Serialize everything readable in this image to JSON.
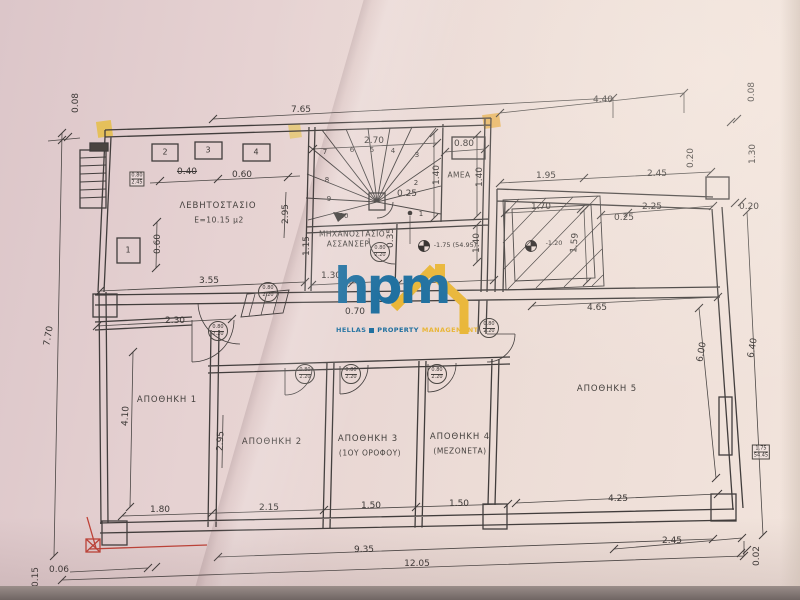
{
  "logo": {
    "wordmark": "hpm",
    "sub1": "HELLAS",
    "sub2": "PROPERTY",
    "sub3": "MANAGEMENT",
    "blue": "#1e6f9f",
    "yellow": "#e9b637"
  },
  "levels_note": "benchmark level markers shown on plan",
  "annotations": [
    {
      "text": "0.08",
      "x": 76,
      "y": 103,
      "rot": -90,
      "cls": "dim"
    },
    {
      "text": "7.65",
      "x": 301,
      "y": 110,
      "cls": "dim"
    },
    {
      "text": "4.40",
      "x": 603,
      "y": 100,
      "cls": "dim"
    },
    {
      "text": "0.08",
      "x": 752,
      "y": 92,
      "rot": -90,
      "cls": "dim"
    },
    {
      "text": "1.30",
      "x": 753,
      "y": 154,
      "rot": -90,
      "cls": "dim"
    },
    {
      "text": "0.20",
      "x": 691,
      "y": 158,
      "rot": -90,
      "cls": "dim"
    },
    {
      "text": "1.95",
      "x": 546,
      "y": 176,
      "cls": "dim"
    },
    {
      "text": "2.45",
      "x": 657,
      "y": 174,
      "cls": "dim"
    },
    {
      "text": "0.20",
      "x": 749,
      "y": 207,
      "cls": "dim"
    },
    {
      "text": "2.25",
      "x": 652,
      "y": 207,
      "cls": "dim"
    },
    {
      "text": "0.25",
      "x": 624,
      "y": 218,
      "cls": "dim"
    },
    {
      "text": "2.70",
      "x": 374,
      "y": 141,
      "cls": "dim"
    },
    {
      "text": "0.80",
      "x": 464,
      "y": 144,
      "cls": "dim"
    },
    {
      "text": "1.40",
      "x": 437,
      "y": 175,
      "rot": -90,
      "cls": "dim"
    },
    {
      "text": "1.40",
      "x": 480,
      "y": 177,
      "rot": -90,
      "cls": "dim"
    },
    {
      "text": "1.40",
      "x": 477,
      "y": 243,
      "rot": -90,
      "cls": "dim"
    },
    {
      "text": "0.25",
      "x": 407,
      "y": 194,
      "cls": "dim"
    },
    {
      "text": "0.35",
      "x": 391,
      "y": 238,
      "rot": -90,
      "cls": "dim"
    },
    {
      "text": "1.15",
      "x": 307,
      "y": 246,
      "rot": -90,
      "cls": "dim"
    },
    {
      "text": "1.30",
      "x": 331,
      "y": 276,
      "cls": "dim"
    },
    {
      "text": "2.10",
      "x": 432,
      "y": 276,
      "cls": "dim"
    },
    {
      "text": "1.70",
      "x": 541,
      "y": 207,
      "cls": "dim"
    },
    {
      "text": "1.59",
      "x": 575,
      "y": 243,
      "rot": -85,
      "cls": "dim"
    },
    {
      "text": "0.40",
      "x": 187,
      "y": 172,
      "cls": "dim",
      "strike": true
    },
    {
      "text": "0.60",
      "x": 242,
      "y": 175,
      "cls": "dim"
    },
    {
      "text": "0.60",
      "x": 158,
      "y": 244,
      "rot": -90,
      "cls": "dim"
    },
    {
      "text": "2.95",
      "x": 286,
      "y": 214,
      "rot": -90,
      "cls": "dim"
    },
    {
      "text": "3.55",
      "x": 209,
      "y": 281,
      "cls": "dim"
    },
    {
      "text": "2.30",
      "x": 175,
      "y": 321,
      "cls": "dim"
    },
    {
      "text": "0.70",
      "x": 355,
      "y": 312,
      "cls": "dim"
    },
    {
      "text": "4.65",
      "x": 597,
      "y": 308,
      "cls": "dim"
    },
    {
      "text": "7.70",
      "x": 49,
      "y": 336,
      "rot": -80,
      "cls": "dim"
    },
    {
      "text": "4.10",
      "x": 126,
      "y": 416,
      "rot": -87,
      "cls": "dim"
    },
    {
      "text": "2.95",
      "x": 221,
      "y": 441,
      "rot": -87,
      "cls": "dim"
    },
    {
      "text": "6.00",
      "x": 702,
      "y": 352,
      "rot": -80,
      "cls": "dim"
    },
    {
      "text": "6.40",
      "x": 753,
      "y": 348,
      "rot": -80,
      "cls": "dim"
    },
    {
      "text": "1.80",
      "x": 160,
      "y": 510,
      "cls": "dim"
    },
    {
      "text": "2.15",
      "x": 269,
      "y": 508,
      "cls": "dim"
    },
    {
      "text": "1.50",
      "x": 371,
      "y": 506,
      "cls": "dim"
    },
    {
      "text": "1.50",
      "x": 459,
      "y": 504,
      "cls": "dim"
    },
    {
      "text": "4.25",
      "x": 618,
      "y": 499,
      "cls": "dim"
    },
    {
      "text": "2.45",
      "x": 672,
      "y": 541,
      "cls": "dim"
    },
    {
      "text": "9.35",
      "x": 364,
      "y": 550,
      "cls": "dim"
    },
    {
      "text": "12.05",
      "x": 417,
      "y": 564,
      "cls": "dim"
    },
    {
      "text": "0.02",
      "x": 757,
      "y": 556,
      "rot": -90,
      "cls": "dim"
    },
    {
      "text": "0.15",
      "x": 36,
      "y": 577,
      "rot": -90,
      "cls": "dim"
    },
    {
      "text": "0.06",
      "x": 59,
      "y": 570,
      "cls": "dim"
    },
    {
      "text": "ΛΕΒΗΤΟΣΤΑΣΙΟ",
      "x": 218,
      "y": 206,
      "cls": "room",
      "name": "room-label-levitostasio"
    },
    {
      "text": "Ε=10.15 μ2",
      "x": 219,
      "y": 220,
      "cls": "roomsub",
      "name": "room-area-levitostasio"
    },
    {
      "text": "ΜΗΧΑΝΟΣΤΑΣΙΟ",
      "x": 352,
      "y": 234,
      "cls": "roomsmall",
      "name": "room-label-mixanostasio"
    },
    {
      "text": "ΑΣΣΑΝΣΕΡ",
      "x": 348,
      "y": 244,
      "cls": "roomsmall",
      "name": "room-label-assanser"
    },
    {
      "text": "ΑΜΕΑ",
      "x": 459,
      "y": 175,
      "cls": "roomsmall",
      "name": "room-label-amea"
    },
    {
      "text": "ΑΠΟΘΗΚΗ 1",
      "x": 167,
      "y": 400,
      "cls": "room",
      "name": "room-label-apothiki-1"
    },
    {
      "text": "ΑΠΟΘΗΚΗ 2",
      "x": 272,
      "y": 442,
      "cls": "room",
      "name": "room-label-apothiki-2"
    },
    {
      "text": "ΑΠΟΘΗΚΗ 3",
      "x": 368,
      "y": 439,
      "cls": "room",
      "name": "room-label-apothiki-3"
    },
    {
      "text": "(1ΟΥ ΟΡΟΦΟΥ)",
      "x": 370,
      "y": 453,
      "cls": "roomsub",
      "name": "room-sub-apothiki-3"
    },
    {
      "text": "ΑΠΟΘΗΚΗ 4",
      "x": 460,
      "y": 437,
      "cls": "room",
      "name": "room-label-apothiki-4"
    },
    {
      "text": "(ΜΕΖΟΝΕΤΑ)",
      "x": 460,
      "y": 451,
      "cls": "roomsub",
      "name": "room-sub-apothiki-4"
    },
    {
      "text": "ΑΠΟΘΗΚΗ 5",
      "x": 607,
      "y": 389,
      "cls": "room",
      "name": "room-label-apothiki-5"
    },
    {
      "text": "-1.75 (54.95)",
      "x": 455,
      "y": 245,
      "cls": "level",
      "name": "level-marker-label"
    },
    {
      "text": "-1.20",
      "x": 554,
      "y": 243,
      "cls": "level",
      "name": "level-marker-label"
    },
    {
      "text": "1",
      "x": 421,
      "y": 214,
      "cls": "snum",
      "name": "stair-step-number"
    },
    {
      "text": "2",
      "x": 416,
      "y": 183,
      "cls": "snum",
      "name": "stair-step-number"
    },
    {
      "text": "3",
      "x": 417,
      "y": 155,
      "cls": "snum",
      "name": "stair-step-number"
    },
    {
      "text": "4",
      "x": 393,
      "y": 151,
      "cls": "snum",
      "name": "stair-step-number"
    },
    {
      "text": "5",
      "x": 372,
      "y": 150,
      "cls": "snum",
      "name": "stair-step-number"
    },
    {
      "text": "6",
      "x": 352,
      "y": 150,
      "cls": "snum",
      "name": "stair-step-number"
    },
    {
      "text": "7",
      "x": 325,
      "y": 152,
      "cls": "snum",
      "name": "stair-step-number"
    },
    {
      "text": "8",
      "x": 327,
      "y": 180,
      "cls": "snum",
      "name": "stair-step-number"
    },
    {
      "text": "9",
      "x": 329,
      "y": 199,
      "cls": "snum",
      "name": "stair-step-number"
    },
    {
      "text": "10",
      "x": 344,
      "y": 216,
      "cls": "snum",
      "name": "stair-step-number"
    },
    {
      "text": "2",
      "x": 165,
      "y": 152,
      "cls": "wnum",
      "name": "opening-number"
    },
    {
      "text": "3",
      "x": 208,
      "y": 150,
      "cls": "wnum",
      "name": "opening-number"
    },
    {
      "text": "4",
      "x": 256,
      "y": 152,
      "cls": "wnum",
      "name": "opening-number"
    },
    {
      "text": "1",
      "x": 128,
      "y": 250,
      "cls": "wnum",
      "name": "opening-number"
    }
  ],
  "door_tags": [
    {
      "top": "0.80",
      "bottom": "2.20",
      "x": 268,
      "y": 292
    },
    {
      "top": "0.80",
      "bottom": "2.20",
      "x": 380,
      "y": 252
    },
    {
      "top": "0.80",
      "bottom": "2.20",
      "x": 218,
      "y": 331
    },
    {
      "top": "0.80",
      "bottom": "2.20",
      "x": 305,
      "y": 374
    },
    {
      "top": "0.80",
      "bottom": "2.20",
      "x": 351,
      "y": 374
    },
    {
      "top": "0.80",
      "bottom": "2.20",
      "x": 437,
      "y": 374
    },
    {
      "top": "0.80",
      "bottom": "2.20",
      "x": 489,
      "y": 328
    }
  ],
  "wall_tags": [
    {
      "rows": [
        "0.80",
        "2.45"
      ],
      "x": 137,
      "y": 179
    },
    {
      "rows": [
        "1.75",
        "54.45"
      ],
      "x": 761,
      "y": 452
    }
  ]
}
